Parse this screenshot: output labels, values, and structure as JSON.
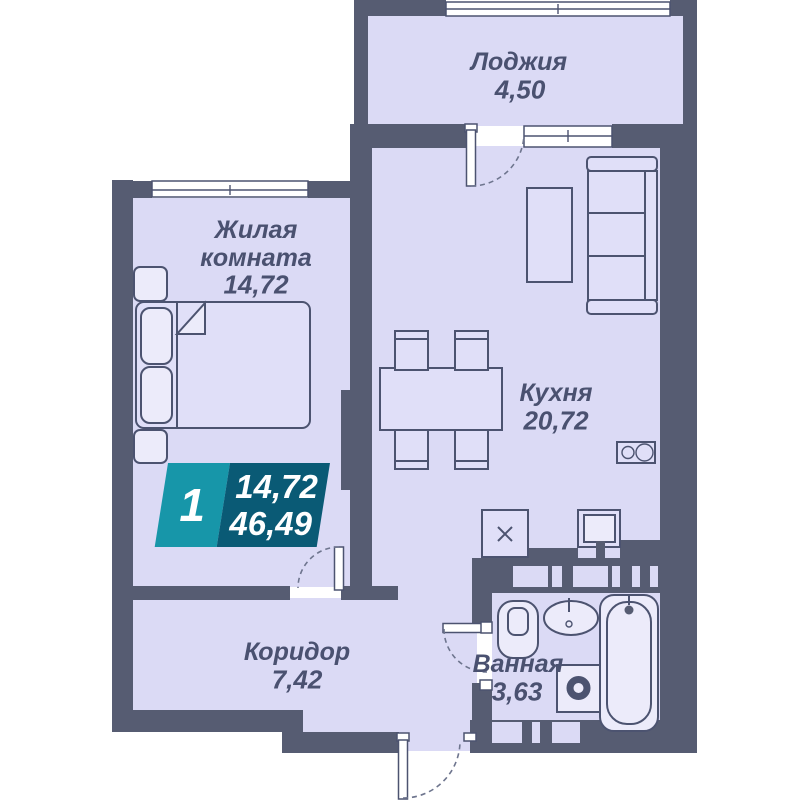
{
  "badge": {
    "rooms_count": "1",
    "living_area": "14,72",
    "total_area": "46,49"
  },
  "rooms": {
    "loggia": {
      "name": "Лоджия",
      "area": "4,50"
    },
    "living": {
      "name_line1": "Жилая",
      "name_line2": "комната",
      "area": "14,72"
    },
    "kitchen": {
      "name": "Кухня",
      "area": "20,72"
    },
    "corridor": {
      "name": "Коридор",
      "area": "7,42"
    },
    "bathroom": {
      "name": "Ванная",
      "area": "3,63"
    }
  },
  "colors": {
    "wall": "#565C72",
    "room": "#DBDAF5",
    "line": "#4C5370",
    "text": "#4A5170",
    "badge_teal": "#1796A9",
    "badge_dark": "#0A5A75"
  }
}
